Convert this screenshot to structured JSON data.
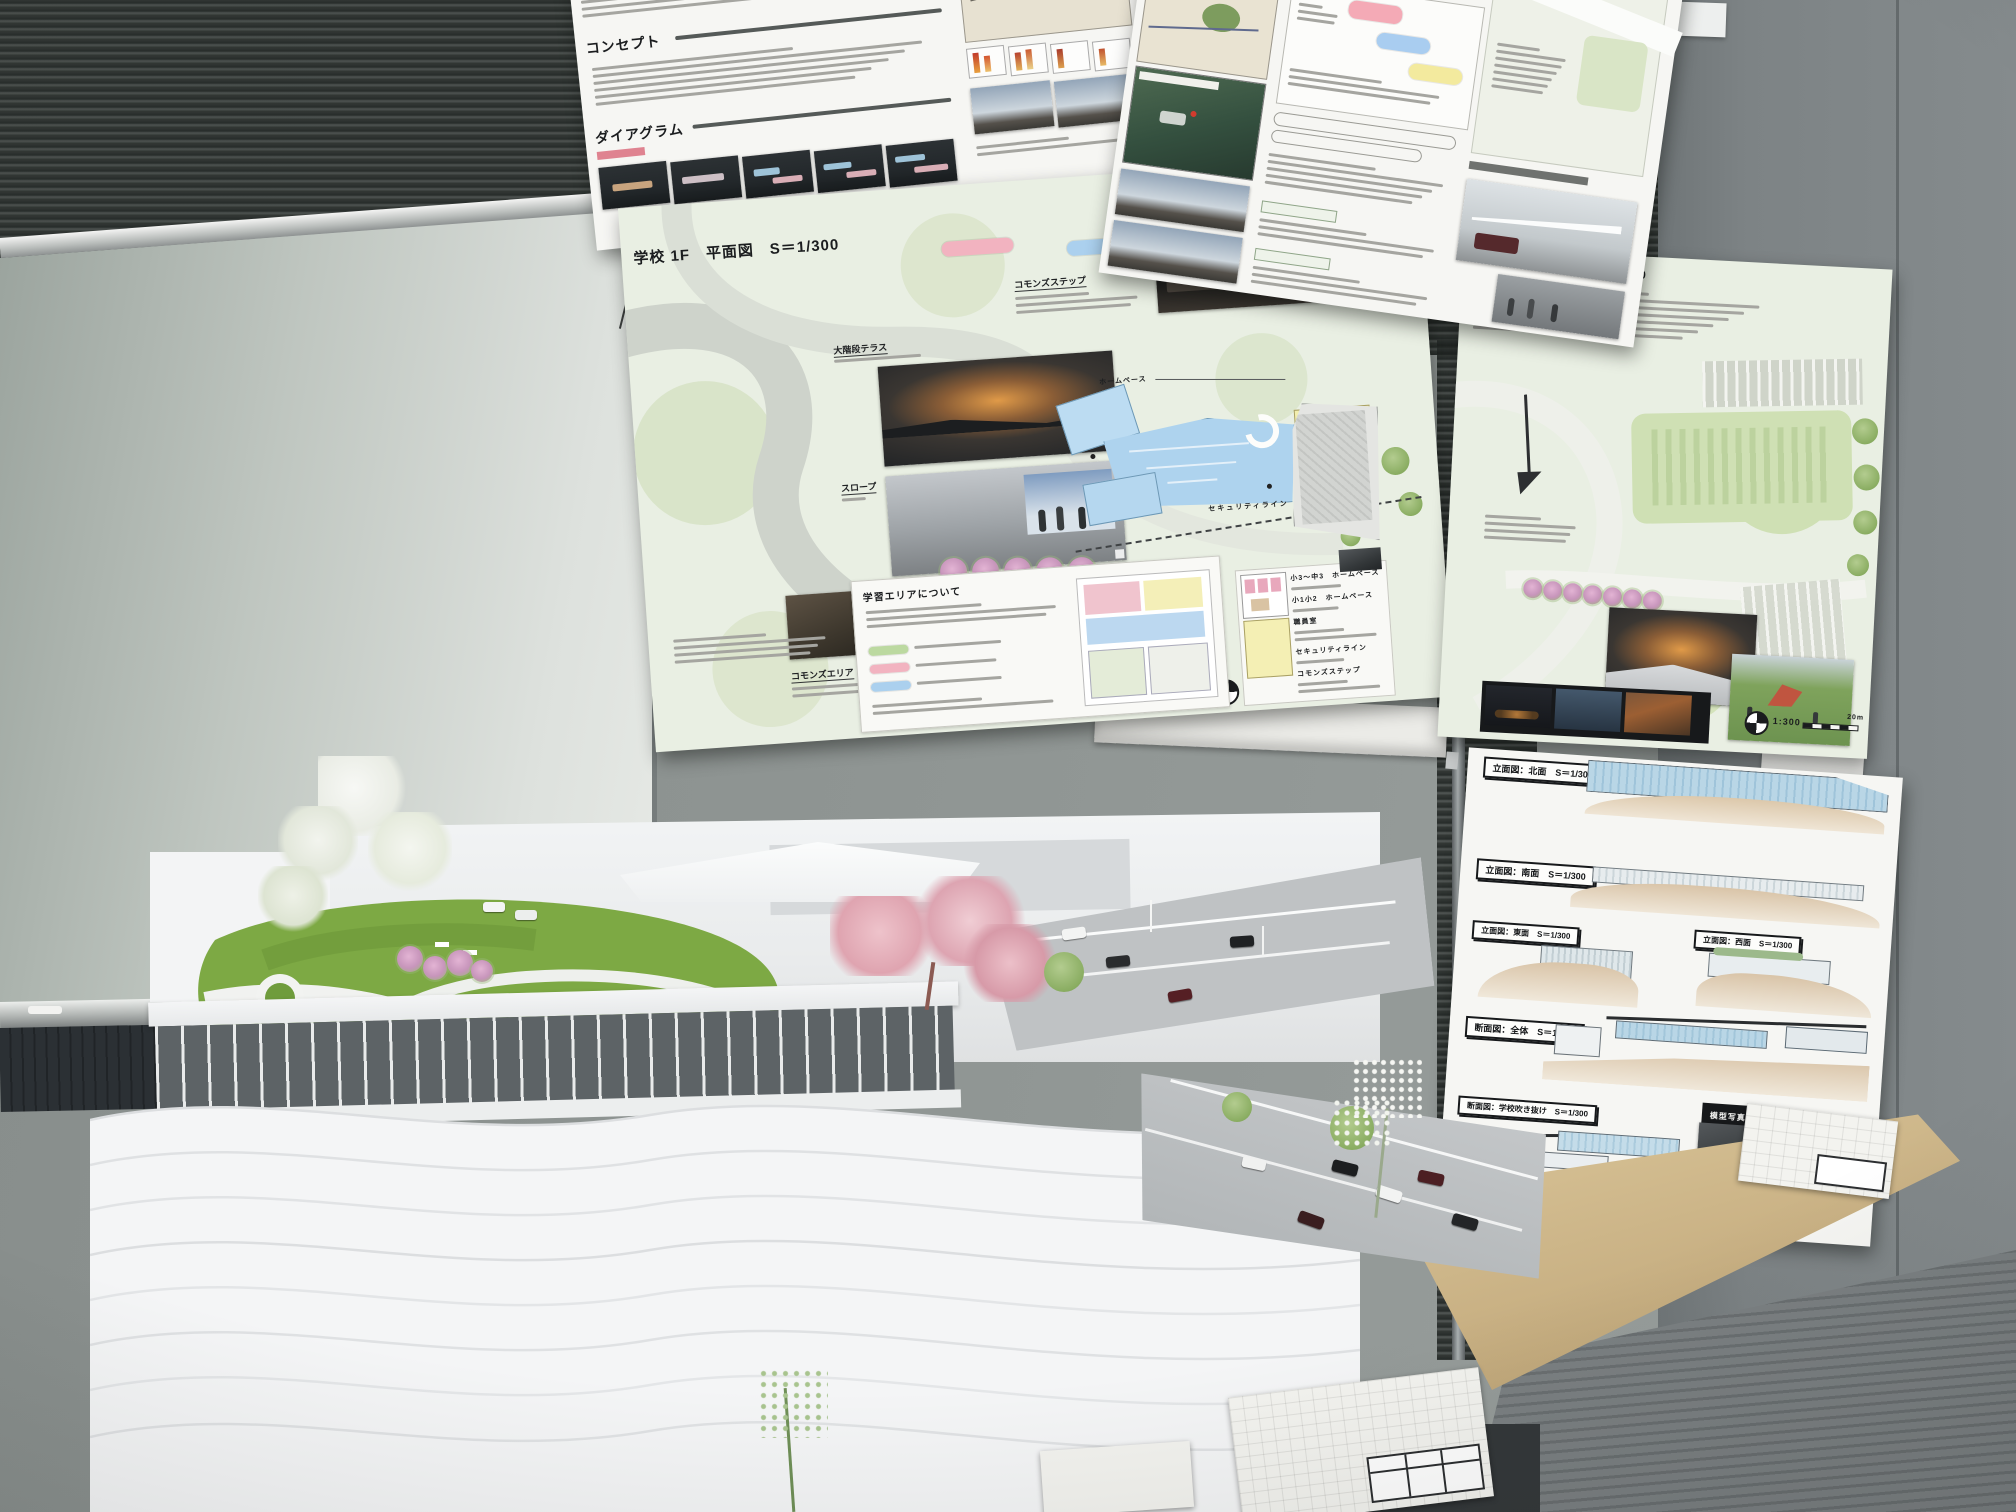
{
  "photo_context": {
    "description": "Architecture studio wall: five presentation boards above a whiteboard and dark venetian blinds, with a large white architectural site model on a wooden table in the foreground"
  },
  "concept_board": {
    "heading_concept": "コンセプト",
    "heading_diagram": "ダイアグラム"
  },
  "building_plan_board": {
    "title": "建物計画について"
  },
  "floor_plan_board": {
    "title": "学校 1F　平面図　S＝1/300",
    "label_commons_step_note": "コモンズステップ",
    "label_grand_stair_terrace": "大階段テラス",
    "label_slope": "スロープ",
    "label_commons_area": "コモンズエリア",
    "label_homebase": "ホームベース",
    "label_security_line_plan": "セキュリティライン",
    "learning_panel_title": "学習エリアについて",
    "label_homebase_upper_grades": "小3～中3　ホームベース",
    "label_homebase_lower_grades": "小1小2　ホームベース",
    "label_staff_room": "職員室",
    "label_security_line": "セキュリティライン",
    "label_commons_step": "コモンズステップ",
    "scale_ratio": "1:300",
    "scale_tick_0": "0",
    "scale_tick_10": "10",
    "scale_tick_20": "20m"
  },
  "site_board": {
    "title": "外構図兼屋上計画図　S＝1/300",
    "scale_ratio": "1:300",
    "scale_tick_20": "20m"
  },
  "sections_board": {
    "elev_north": "立面図：北面　S＝1/300",
    "elev_south": "立面図：南面　S＝1/300",
    "elev_east": "立面図：東面　S＝1/300",
    "elev_west": "立面図：西面　S＝1/300",
    "section_overall": "断面図：全体　S＝1/300",
    "section_atrium": "断面図：学校吹き抜け　S＝1/300",
    "model_photos": "模型写真"
  },
  "colors": {
    "plan_blue": "#aed3ee",
    "plan_yellow": "#f2eeae",
    "sakura_pink": "#cf9ec4",
    "turf_green": "#7da944",
    "board_green_bg": "#e9efe3",
    "elevation_blue": "#b9d6e6",
    "ground_tan": "#d9c4a8"
  }
}
